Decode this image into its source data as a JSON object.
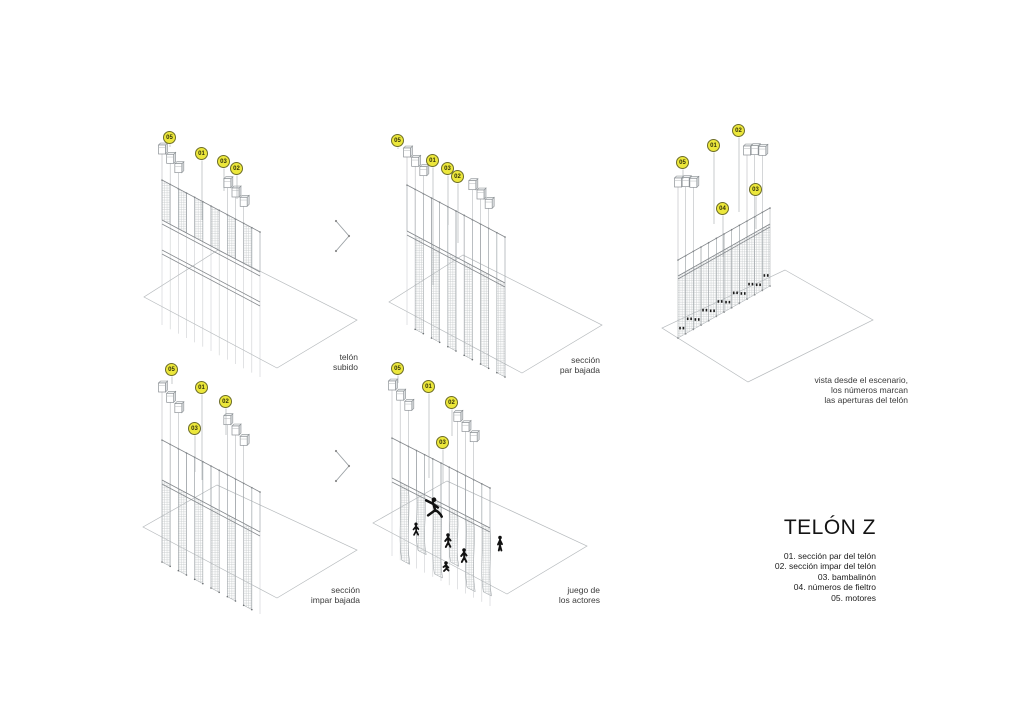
{
  "title_block": {
    "title": "TELÓN Z",
    "legend": [
      "01. sección par del telón",
      "02. sección impar del telón",
      "03. bambalinón",
      "04. números de fieltro",
      "05. motores"
    ]
  },
  "diagrams": [
    {
      "caption": "telón\nsubido",
      "badges": [
        "05",
        "01",
        "03",
        "02"
      ]
    },
    {
      "caption": "sección\npar bajada",
      "badges": [
        "05",
        "01",
        "03",
        "02"
      ]
    },
    {
      "caption": "vista desde el escenario,\nlos números marcan\nlas aperturas del telón",
      "badges": [
        "05",
        "01",
        "02",
        "04",
        "03"
      ]
    },
    {
      "caption": "sección\nimpar bajada",
      "badges": [
        "05",
        "01",
        "02",
        "03"
      ]
    },
    {
      "caption": "juego de\nlos actores",
      "badges": [
        "05",
        "01",
        "02",
        "03"
      ]
    }
  ],
  "icons": {
    "flow_arrow": "chevron-right"
  },
  "colors": {
    "badge_fill": "#ece73b",
    "badge_stroke": "#6d6d28",
    "line_gray": "#9aa0a4",
    "line_light": "#bcc0c3",
    "floor_gray": "#b7bbbe",
    "ink": "#1b1b1b"
  }
}
